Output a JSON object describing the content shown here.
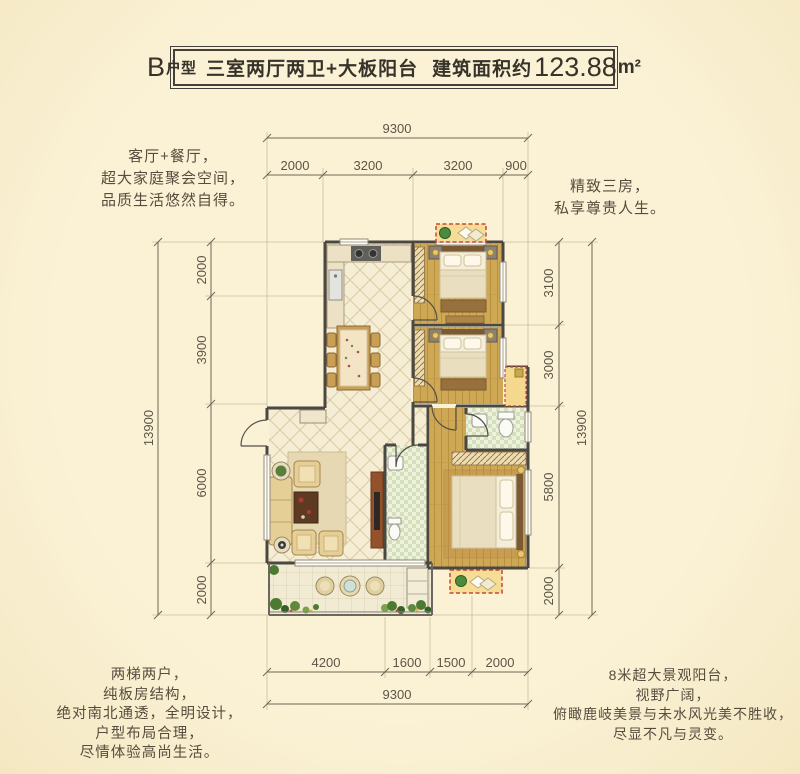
{
  "title": {
    "model": "B",
    "model_suffix": "户型",
    "desc": "三室两厅两卫+大板阳台",
    "area_label": "建筑面积约",
    "area_value": "123.88",
    "area_unit": "m²"
  },
  "annotations": {
    "top_left": {
      "lines": [
        "客厅+餐厅，",
        "超大家庭聚会空间，",
        "品质生活悠然自得。"
      ]
    },
    "top_right": {
      "lines": [
        "精致三房，",
        "私享尊贵人生。"
      ]
    },
    "bottom_left": {
      "lines": [
        "两梯两户，",
        "纯板房结构，",
        "绝对南北通透，全明设计，",
        "户型布局合理，",
        "尽情体验高尚生活。"
      ]
    },
    "bottom_right": {
      "lines": [
        "8米超大景观阳台，",
        "视野广阔，",
        "俯瞰鹿岐美景与未水风光美不胜收，",
        "尽显不凡与灵变。"
      ]
    }
  },
  "dimensions": {
    "top": {
      "overall": "9300",
      "segments": [
        "2000",
        "3200",
        "3200",
        "900"
      ]
    },
    "bottom": {
      "overall": "9300",
      "segments": [
        "4200",
        "1600",
        "1500",
        "2000"
      ]
    },
    "left": {
      "overall": "13900",
      "segments": [
        "2000",
        "3900",
        "6000",
        "2000"
      ]
    },
    "right": {
      "overall": "13900",
      "segments": [
        "3100",
        "3000",
        "5800",
        "2000"
      ]
    }
  },
  "colors": {
    "background": "#fbf2d6",
    "background_edge": "#f4e8c2",
    "frame": "#45403a",
    "title_text": "#37322a",
    "text": "#564d3e",
    "dim_text": "#5d5546",
    "dim_line": "#6f6656",
    "ext_line": "#c9bd9c",
    "wall": "#4b4741",
    "accent_red": "#c2493d",
    "balcony_yellow": "#f6dd96",
    "wood_floor": "#cfa855",
    "bath_green": "#d3e0ba",
    "tile_line": "#d9cba4"
  }
}
